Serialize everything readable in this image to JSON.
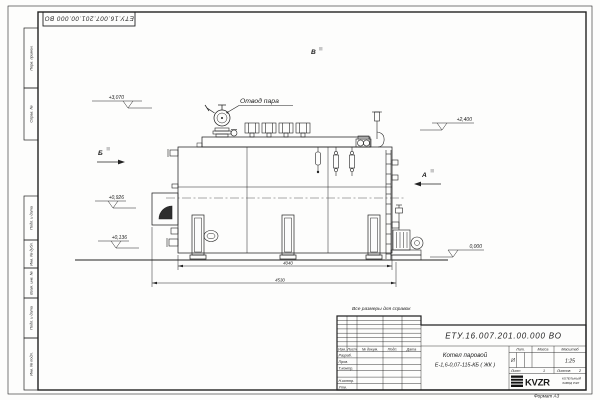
{
  "sheet": {
    "stamp": "ЕТУ.16.007.201.00.000  ВО",
    "note": "Все размеры для справок",
    "format": "Формат  А3"
  },
  "margin_labels": [
    "Перв. примен.",
    "Справ. №",
    "Подп. и дата",
    "Инв. № дубл.",
    "Взам. инв. №",
    "Подп. и дата",
    "Инв. № подл."
  ],
  "drawing": {
    "callout_steam": "Отвод пара",
    "dim_inner": "4040",
    "dim_outer": "4530",
    "elev_top_left": "+3,070",
    "elev_mid_left": "+0,926",
    "elev_low_left": "+0,136",
    "elev_top_right": "+2,400",
    "elev_zero": "0,000",
    "view_b": "Б",
    "view_a": "А",
    "view_v": "В"
  },
  "title_block": {
    "designation": "ЕТУ.16.007.201.00.000  ВО",
    "product_line1": "Котел паровой",
    "product_line2": "Е-1,6-0,07-115-КБ ( ЖК )",
    "col_izm": "Изм.",
    "col_list": "Лист",
    "col_doc": "№ докум.",
    "col_podp": "Подп.",
    "col_data": "Дата",
    "rows": [
      "Разраб.",
      "Пров.",
      "Т.контр.",
      "Н.контр.",
      "Утв."
    ],
    "lit_label": "Лит.",
    "lit_value": "И",
    "mass_label": "Масса",
    "scale_label": "Масштаб",
    "scale_value": "1:25",
    "sheet_label": "Лист",
    "sheet_value": "1",
    "sheets_label": "Листов",
    "sheets_value": "2",
    "logo_text": "KVZR",
    "company_line1": "КОТЕЛЬНЫЙ",
    "company_line2": "ЗАВОД РЭП"
  }
}
